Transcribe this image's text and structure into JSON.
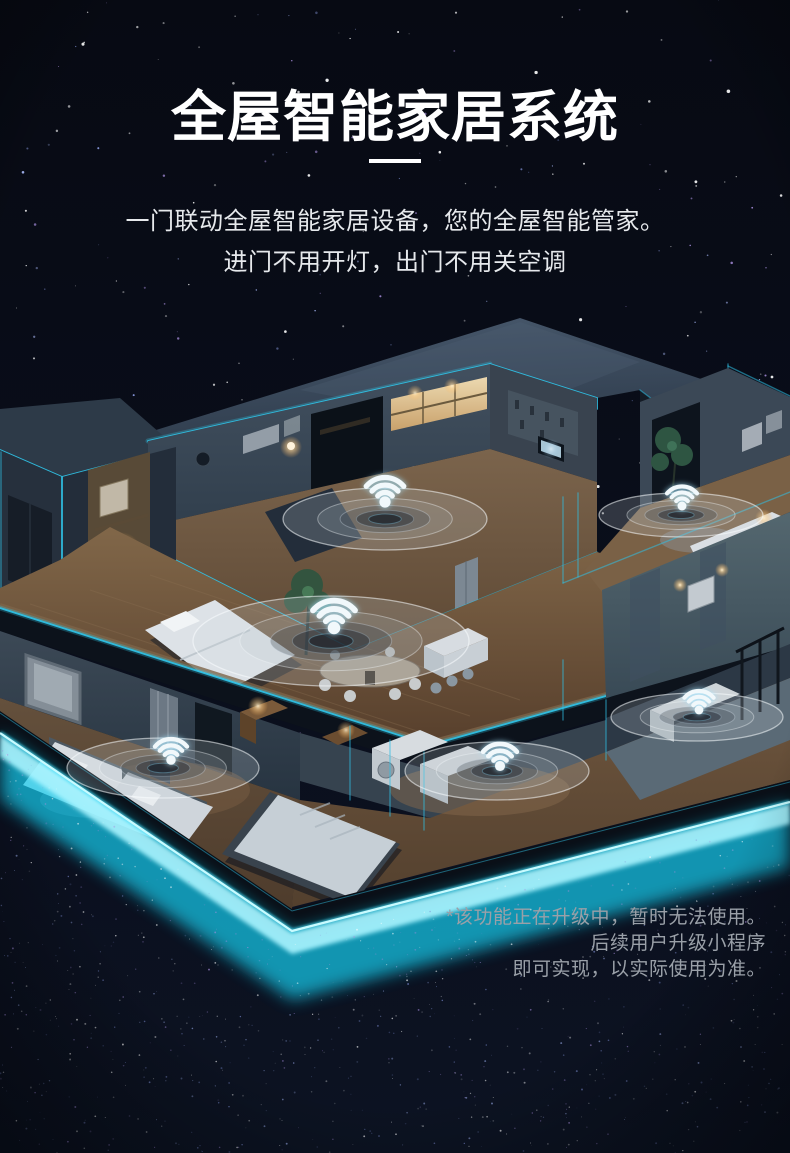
{
  "page": {
    "title": "全屋智能家居系统",
    "subtitle_line1": "一门联动全屋智能家居设备，您的全屋智能管家。",
    "subtitle_line2": "进门不用开灯，出门不用关空调",
    "disclaimer_lines": [
      "*该功能正在升级中，暂时无法使用。",
      "后续用户升级小程序",
      "即可实现，以实际使用为准。"
    ]
  },
  "colors": {
    "background": "#090d19",
    "title": "#ffffff",
    "subtitle": "#e6e9ec",
    "disclaimer": "#9aa0a8",
    "accent_cyan_line": "#2fc0e4",
    "base_glow_cyan": "#19e6ff",
    "wifi_glyph": "#f1f8fb"
  },
  "illustration": {
    "description": "isometric cutaway smart home at night with wifi coverage ripples and neon cyan edge lighting",
    "wifi_icon": "wifi-signal-icon",
    "wifi_nodes": [
      {
        "id": "wifi-upper-studio",
        "dot": [
          385,
          502
        ],
        "ripple": [
          385,
          519,
          102,
          31
        ],
        "s": 1.0
      },
      {
        "id": "wifi-upper-lounge",
        "dot": [
          682,
          506
        ],
        "ripple": [
          681,
          515,
          82,
          22
        ],
        "s": 0.8
      },
      {
        "id": "wifi-dining-deck",
        "dot": [
          334,
          628
        ],
        "ripple": [
          331,
          641,
          138,
          45
        ],
        "s": 1.12
      },
      {
        "id": "wifi-bedroom-left",
        "dot": [
          171,
          760
        ],
        "ripple": [
          163,
          768,
          96,
          30
        ],
        "s": 0.85
      },
      {
        "id": "wifi-kitchen-lower",
        "dot": [
          500,
          766
        ],
        "ripple": [
          497,
          771,
          92,
          29
        ],
        "s": 0.9
      },
      {
        "id": "wifi-bathroom",
        "dot": [
          699,
          710
        ],
        "ripple": [
          697,
          717,
          86,
          24
        ],
        "s": 0.78
      }
    ]
  }
}
